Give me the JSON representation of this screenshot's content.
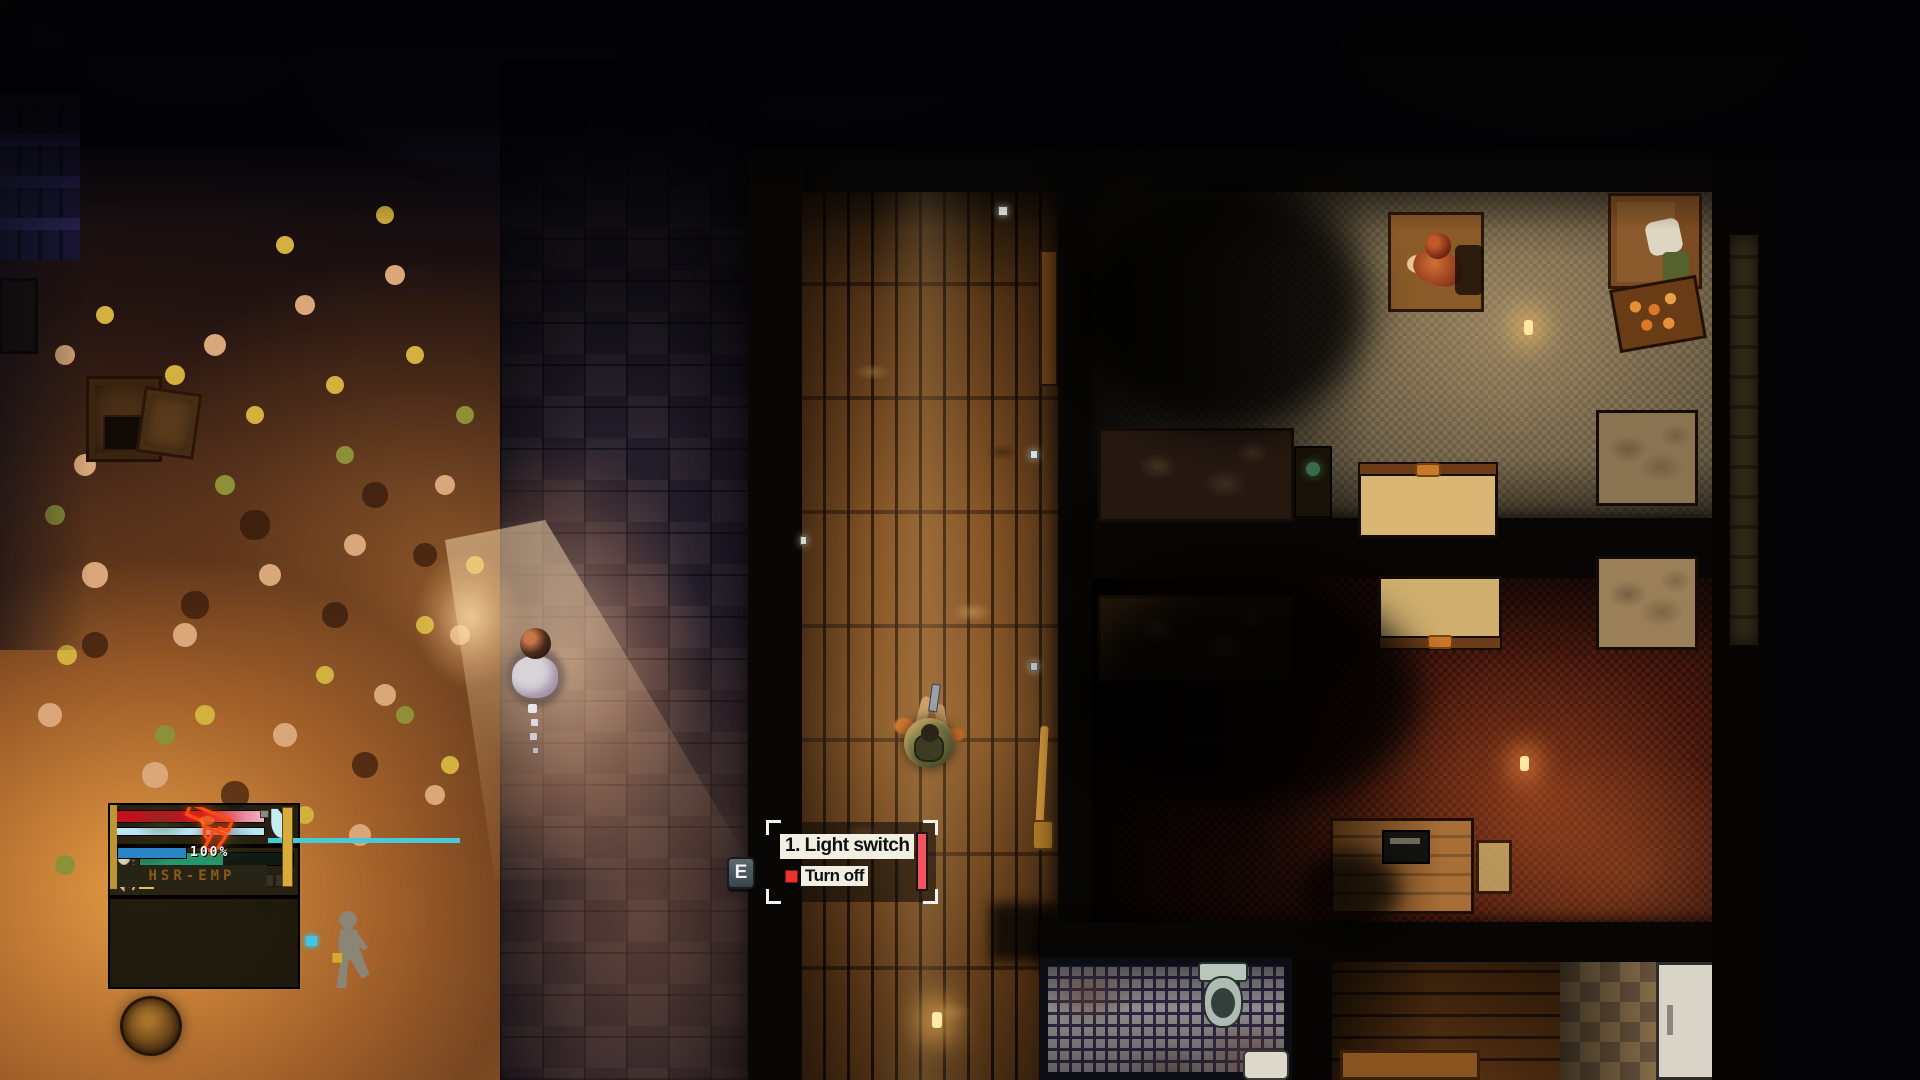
{
  "interaction_prompt": {
    "key": "E",
    "title": "1. Light switch",
    "action": "Turn off",
    "bar_color": "#f4535f",
    "bullet_color": "#e8332e"
  },
  "hud": {
    "ammo_percent": "100%",
    "weapon_name": "HSR-EMP",
    "bars": {
      "health": 100,
      "exposure": 100,
      "armor": 100,
      "stamina": 54,
      "ammo": 100
    },
    "sound_meter": {
      "segments": 14,
      "active_segment": 1
    },
    "colors": {
      "health_red": "#c40f1e",
      "health_soft_pink": "#f2b3c2",
      "exposure_cyan": "#b9e6f7",
      "armor_cyan": "#49c8d8",
      "stamina_green": "#23996b",
      "ammo_blue": "#2a84c8",
      "weapon_outline_red": "#ff4a14",
      "hud_gold": "#d8ac3c",
      "weapon_name_amber": "#8a5a16",
      "stance_dot_cyan": "#3fc6e4"
    },
    "icons": [
      "armor-vest-icon",
      "stamina-bulb-icon",
      "sound-speaker-icon",
      "weapon-pistol-icon",
      "stance-walking-icon"
    ]
  },
  "scene": {
    "objects": [
      "npc-on-path",
      "player-character",
      "stone-path",
      "wood-hallway",
      "grey-carpet-room",
      "red-carpet-room",
      "beds",
      "couch",
      "orange-crate",
      "table-with-person",
      "desk",
      "toilet",
      "sink",
      "fridge",
      "kitchen-tiles",
      "manhole-cover",
      "crates",
      "candles",
      "light-switch",
      "door",
      "broom",
      "street-light-cone"
    ]
  }
}
